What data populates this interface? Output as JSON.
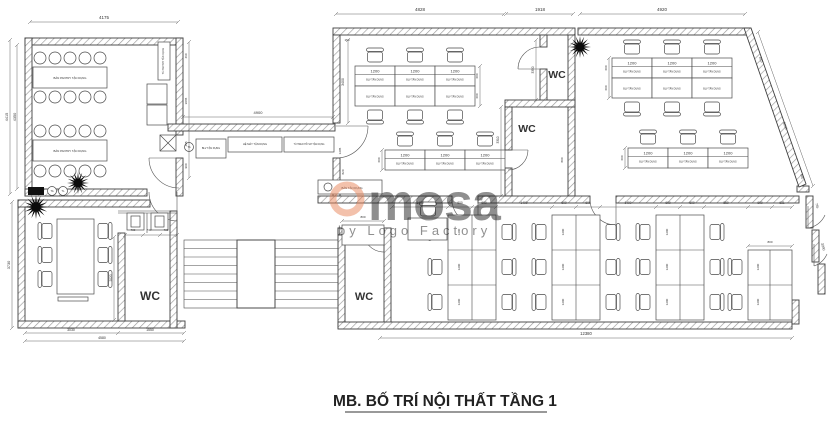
{
  "drawing": {
    "title": "MB. BỐ TRÍ NỘI THẤT TẦNG 1",
    "watermark": {
      "brand": "mosa",
      "byline": "by Logo Factory",
      "accent_color": "#E8845A"
    },
    "room_labels": {
      "wc": "WC"
    },
    "furniture_labels": {
      "desk_size": "1200",
      "desk": "BLV TẬN DỤNG",
      "pantry_table": "BÀN PANTRY TẬN DỤNG",
      "pantry_cabinet": "TỦ PANTRY TẬN DỤNG",
      "corridor_desk": "BLV TẬN DỤNG",
      "machine_unit": "HỆ MÁY TẬN DỤNG",
      "file_cabinet": "TỦ TREO HỒ SƠ TẬN DỤNG",
      "reused_bench": "BÀN TẬN DỤNG",
      "tag_a": "TA",
      "tag_b": "TL"
    },
    "dimensions": {
      "4175": "4175",
      "4828": "4828",
      "1918": "1918",
      "4920": "4920",
      "4900": "4900",
      "4415": "4415",
      "4350": "4350",
      "3730": "3730",
      "460": "460",
      "3065": "3065",
      "465": "465",
      "900": "900",
      "3400": "3400",
      "820": "820",
      "600": "600",
      "1200": "1200",
      "3350": "3350",
      "3310": "3310",
      "800": "800",
      "815": "815",
      "3000": "3000",
      "560": "560",
      "735": "735",
      "700": "700",
      "730": "730",
      "2020": "2020",
      "3030": "3030",
      "1550": "1550",
      "4580": "4580",
      "1400": "1400",
      "631": "631",
      "850": "850",
      "12380": "12380",
      "3090": "3090",
      "1205": "1205",
      "870": "870",
      "150": "150"
    }
  }
}
